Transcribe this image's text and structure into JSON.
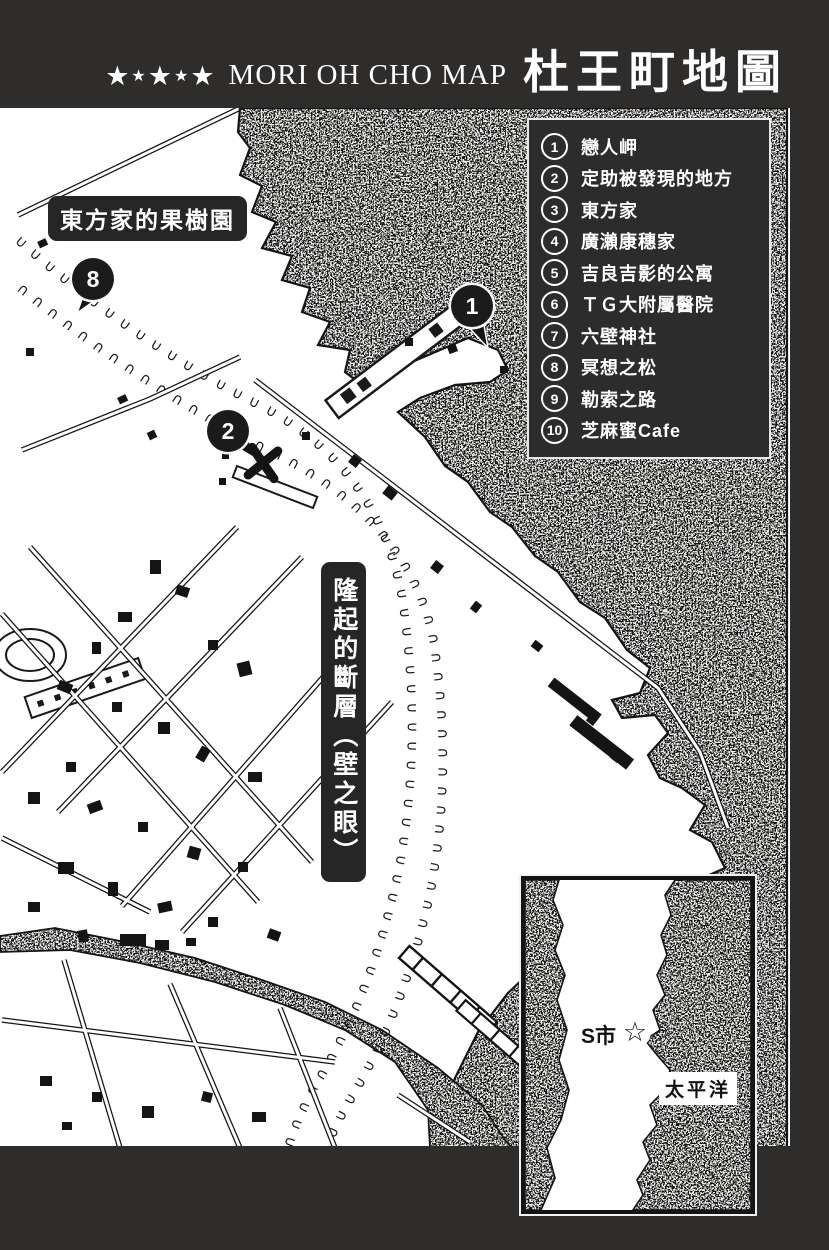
{
  "title": {
    "stars": [
      "★",
      "★",
      "★",
      "★",
      "★"
    ],
    "romaji": "MORI OH CHO MAP",
    "kanji": "杜王町地圖"
  },
  "legend": {
    "items": [
      {
        "num": "1",
        "label": "戀人岬"
      },
      {
        "num": "2",
        "label": "定助被發現的地方"
      },
      {
        "num": "3",
        "label": "東方家"
      },
      {
        "num": "4",
        "label": "廣瀨康穗家"
      },
      {
        "num": "5",
        "label": "吉良吉影的公寓"
      },
      {
        "num": "6",
        "label": "ＴＧ大附屬醫院"
      },
      {
        "num": "7",
        "label": "六壁神社"
      },
      {
        "num": "8",
        "label": "冥想之松"
      },
      {
        "num": "9",
        "label": "勒索之路"
      },
      {
        "num": "10",
        "label": "芝麻蜜Cafe"
      }
    ]
  },
  "map_labels": {
    "orchard": "東方家的果樹園",
    "fault": "隆起的斷層（壁之眼）"
  },
  "markers": [
    {
      "num": "1"
    },
    {
      "num": "2"
    },
    {
      "num": "8"
    }
  ],
  "inset": {
    "city": "S市",
    "star": "☆",
    "ocean": "太平洋"
  },
  "colors": {
    "page_band": "#2e2d2b",
    "ink": "#141414",
    "panel": "#ffffff",
    "label_box": "#262626",
    "legend_box": "#2c2c2c"
  }
}
